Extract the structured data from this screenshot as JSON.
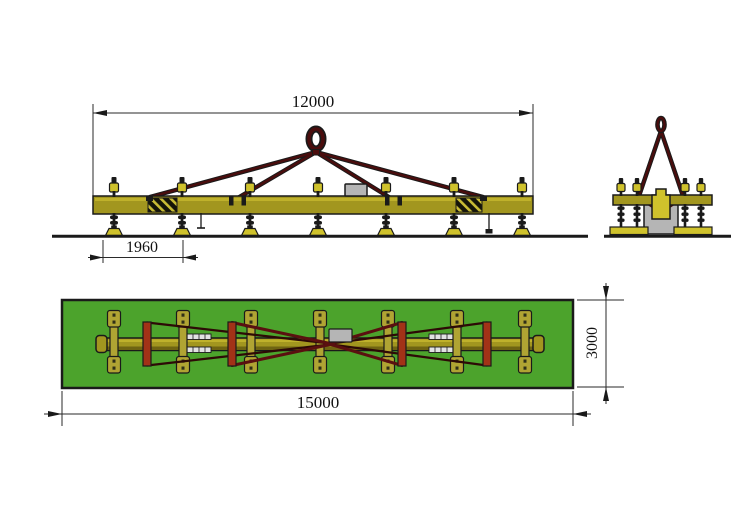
{
  "drawing": {
    "front_view": {
      "beam_length_label": "12000",
      "foot_spacing_label": "1960"
    },
    "plan_view": {
      "plate_length_label": "15000",
      "plate_width_label": "3000"
    },
    "colors": {
      "beam_yellow": "#a2961f",
      "arm_yellow": "#b0a433",
      "pad_yellow": "#cfc22c",
      "sling_red": "#4a0d0d",
      "crossbar_red": "#a23217",
      "plate_green": "#4ca32c",
      "box_gray": "#b5b5b5",
      "line_black": "#1a1a1a"
    }
  }
}
